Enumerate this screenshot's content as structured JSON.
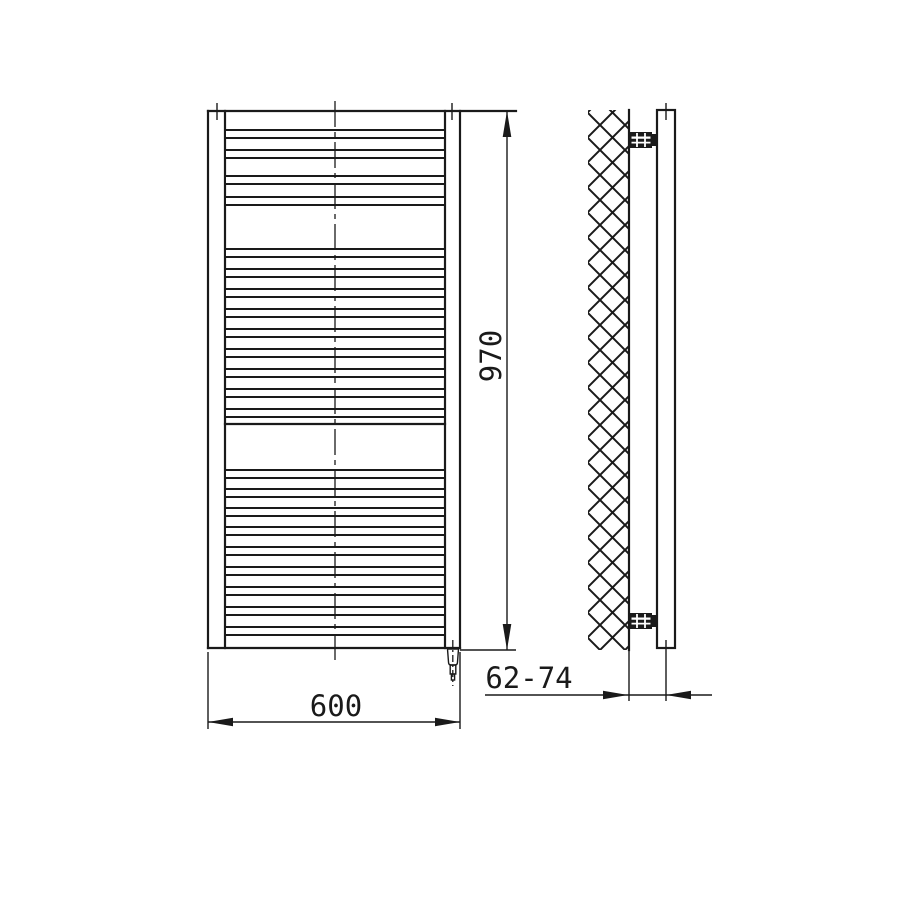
{
  "drawing": {
    "type": "technical-drawing",
    "subject": "ladder towel radiator, front and side elevation with wall mounting",
    "colors": {
      "line": "#1a1a1a",
      "background": "#ffffff"
    },
    "dimensions": {
      "width": "600",
      "height": "970",
      "wall_distance": "62-74"
    }
  }
}
